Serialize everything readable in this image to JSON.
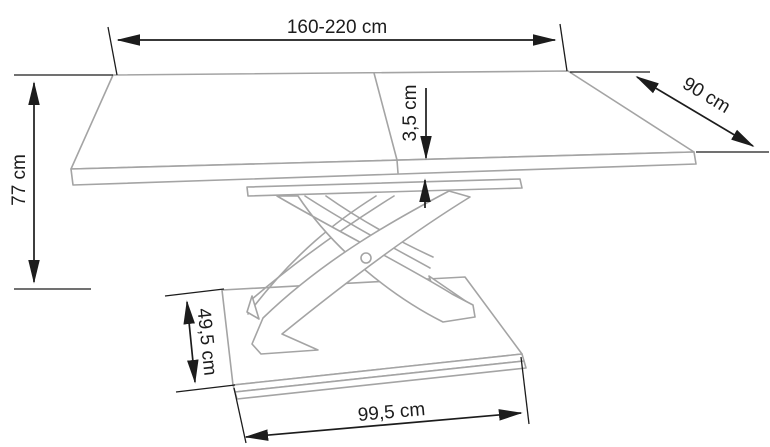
{
  "page": {
    "width_px": 770,
    "height_px": 447,
    "background_color": "#ffffff"
  },
  "diagram": {
    "type": "furniture-dimension-drawing",
    "subject": "extendable table with X-shaped pedestal base on a rectangular base plate",
    "outline_color": "#a4a4a4",
    "dimension_color": "#1c1c1c",
    "dimensions": {
      "table_length": {
        "label": "160-220 cm"
      },
      "table_depth": {
        "label": "90 cm"
      },
      "table_height": {
        "label": "77 cm"
      },
      "top_thickness": {
        "label": "3,5 cm"
      },
      "base_depth": {
        "label": "49,5 cm"
      },
      "base_length": {
        "label": "99,5 cm"
      }
    }
  }
}
